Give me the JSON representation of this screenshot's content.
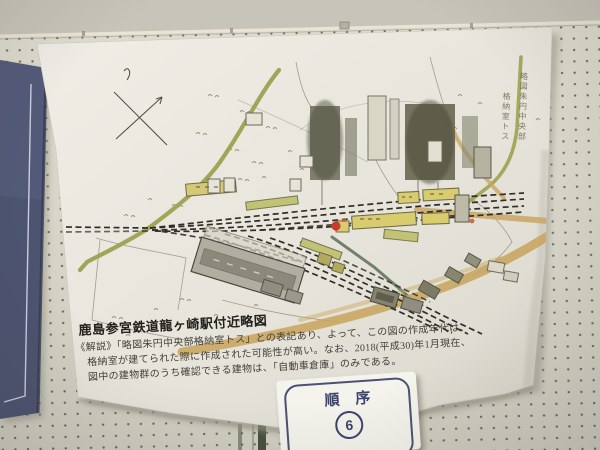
{
  "poster": {
    "title": "鹿島参宮鉄道龍ヶ崎駅付近略図",
    "caption_lines": [
      "《解説》「略図朱円中央部格納室トス」との表記あり、よって、この図の作成年代は、",
      "格納室が建てられた際に作成された可能性が高い。なお、2018(平成30)年1月現在、",
      "図中の建物群のうち確認できる建物は、「自動車倉庫」のみである。"
    ],
    "inscription_columns": {
      "right": "略図朱円中央部",
      "left": "格納室トス"
    }
  },
  "order_card": {
    "label": "順序",
    "number": "6"
  },
  "icons": {
    "compass": "compass-cross-icon",
    "red_circle": "red-circle-marker"
  },
  "colors": {
    "wall": "#c7c4ba",
    "pegboard": "#d8d7c9",
    "paper": "#eae8df",
    "blue_poster": "#4d5471",
    "road_green": "#9ca24f",
    "road_tan": "#c8a35c",
    "track_ink": "#2f2e27",
    "building_yellow": "#d9cc6f",
    "red_mark": "#c93524",
    "card_navy": "#3c4370"
  }
}
